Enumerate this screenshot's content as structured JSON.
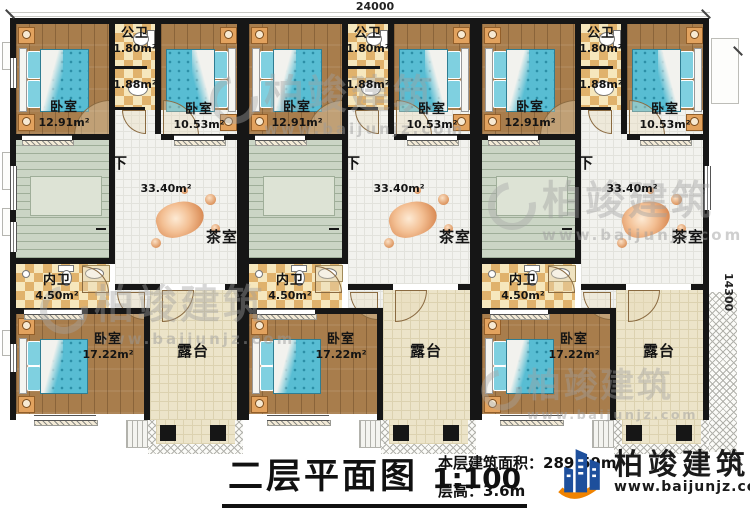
{
  "dimensions": {
    "width": "24000",
    "height": "14300"
  },
  "title_block": {
    "title": "二层平面图",
    "scale": "1:100",
    "area_label": "本层建筑面积：",
    "area_value": "289.59m²",
    "height_label": "层高：",
    "height_value": "3.6m"
  },
  "logo": {
    "name": "柏竣建筑",
    "site": "www.baijunjz.com"
  },
  "watermark": {
    "name": "柏竣建筑",
    "site": "www.baijunjz.com"
  },
  "units": [
    {
      "bedroom_top_left": {
        "label": "卧室",
        "area": "12.91m²"
      },
      "public_bath": {
        "label": "公卫",
        "area": "1.80m²"
      },
      "public_bath_lower": {
        "area": "1.88m²"
      },
      "bedroom_top_right": {
        "label": "卧室",
        "area": "10.53m²"
      },
      "stairs": {
        "down_label": "下"
      },
      "tea_room": {
        "label": "茶室",
        "area": "33.40m²"
      },
      "inner_bath": {
        "label": "内卫",
        "area": "4.50m²"
      },
      "bedroom_bottom": {
        "label": "卧室",
        "area": "17.22m²"
      },
      "terrace": {
        "label": "露台"
      }
    },
    {
      "bedroom_top_left": {
        "label": "卧室",
        "area": "12.91m²"
      },
      "public_bath": {
        "label": "公卫",
        "area": "1.80m²"
      },
      "public_bath_lower": {
        "area": "1.88m²"
      },
      "bedroom_top_right": {
        "label": "卧室",
        "area": "10.53m²"
      },
      "stairs": {
        "down_label": "下"
      },
      "tea_room": {
        "label": "茶室",
        "area": "33.40m²"
      },
      "inner_bath": {
        "label": "内卫",
        "area": "4.50m²"
      },
      "bedroom_bottom": {
        "label": "卧室",
        "area": "17.22m²"
      },
      "terrace": {
        "label": "露台"
      }
    },
    {
      "bedroom_top_left": {
        "label": "卧室",
        "area": "12.91m²"
      },
      "public_bath": {
        "label": "公卫",
        "area": "1.80m²"
      },
      "public_bath_lower": {
        "area": "1.88m²"
      },
      "bedroom_top_right": {
        "label": "卧室",
        "area": "10.53m²"
      },
      "stairs": {
        "down_label": "下"
      },
      "tea_room": {
        "label": "茶室",
        "area": "33.40m²"
      },
      "inner_bath": {
        "label": "内卫",
        "area": "4.50m²"
      },
      "bedroom_bottom": {
        "label": "卧室",
        "area": "17.22m²"
      },
      "terrace": {
        "label": "露台"
      }
    }
  ],
  "colors": {
    "wall": "#161616",
    "wood_floor": "#a87d4c",
    "checker_tile": "#e0b26c",
    "tea_floor": "#f2f2ee",
    "stair_floor": "#cbd5c5",
    "terrace_floor": "#ece4c9",
    "bed_blue": "#58bdd3",
    "logo_blue": "#1d4f9c",
    "logo_orange": "#f08300"
  }
}
